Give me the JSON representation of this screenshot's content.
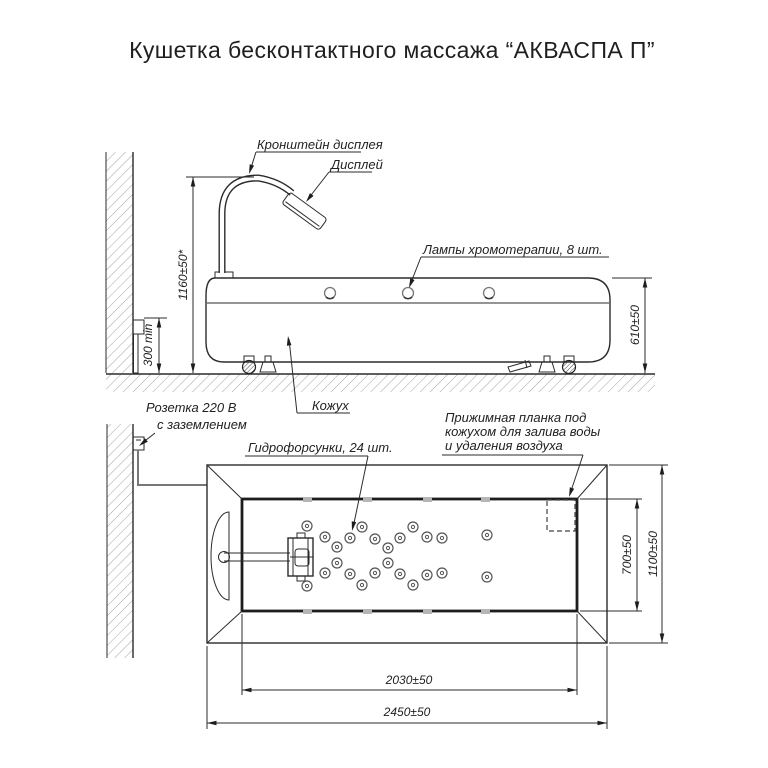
{
  "title": "Кушетка бесконтактного массажа “АКВАСПА П”",
  "side_view": {
    "labels": {
      "bracket": "Кронштейн дисплея",
      "display": "Дисплей",
      "lamps": "Лампы хромотерапии, 8 шт.",
      "cover": "Кожух"
    },
    "dimensions": {
      "height_display": "1160±50*",
      "socket_height": "300 min",
      "couch_height": "610±50"
    },
    "lamp_count_note": "8"
  },
  "plan_view": {
    "labels": {
      "socket_line1": "Розетка 220 В",
      "socket_line2": "с заземлением",
      "nozzles": "Гидрофорсунки, 24 шт.",
      "plate_line1": "Прижимная планка под",
      "plate_line2": "кожухом для залива воды",
      "plate_line3": "и удаления воздуха"
    },
    "dimensions": {
      "inner_width": "700±50",
      "outer_width": "1100±50",
      "inner_length": "2030±50",
      "outer_length": "2450±50"
    },
    "nozzle_count": 24
  },
  "colors": {
    "line": "#2b2b2b",
    "hatch": "#a3a3a3",
    "background": "#ffffff"
  }
}
